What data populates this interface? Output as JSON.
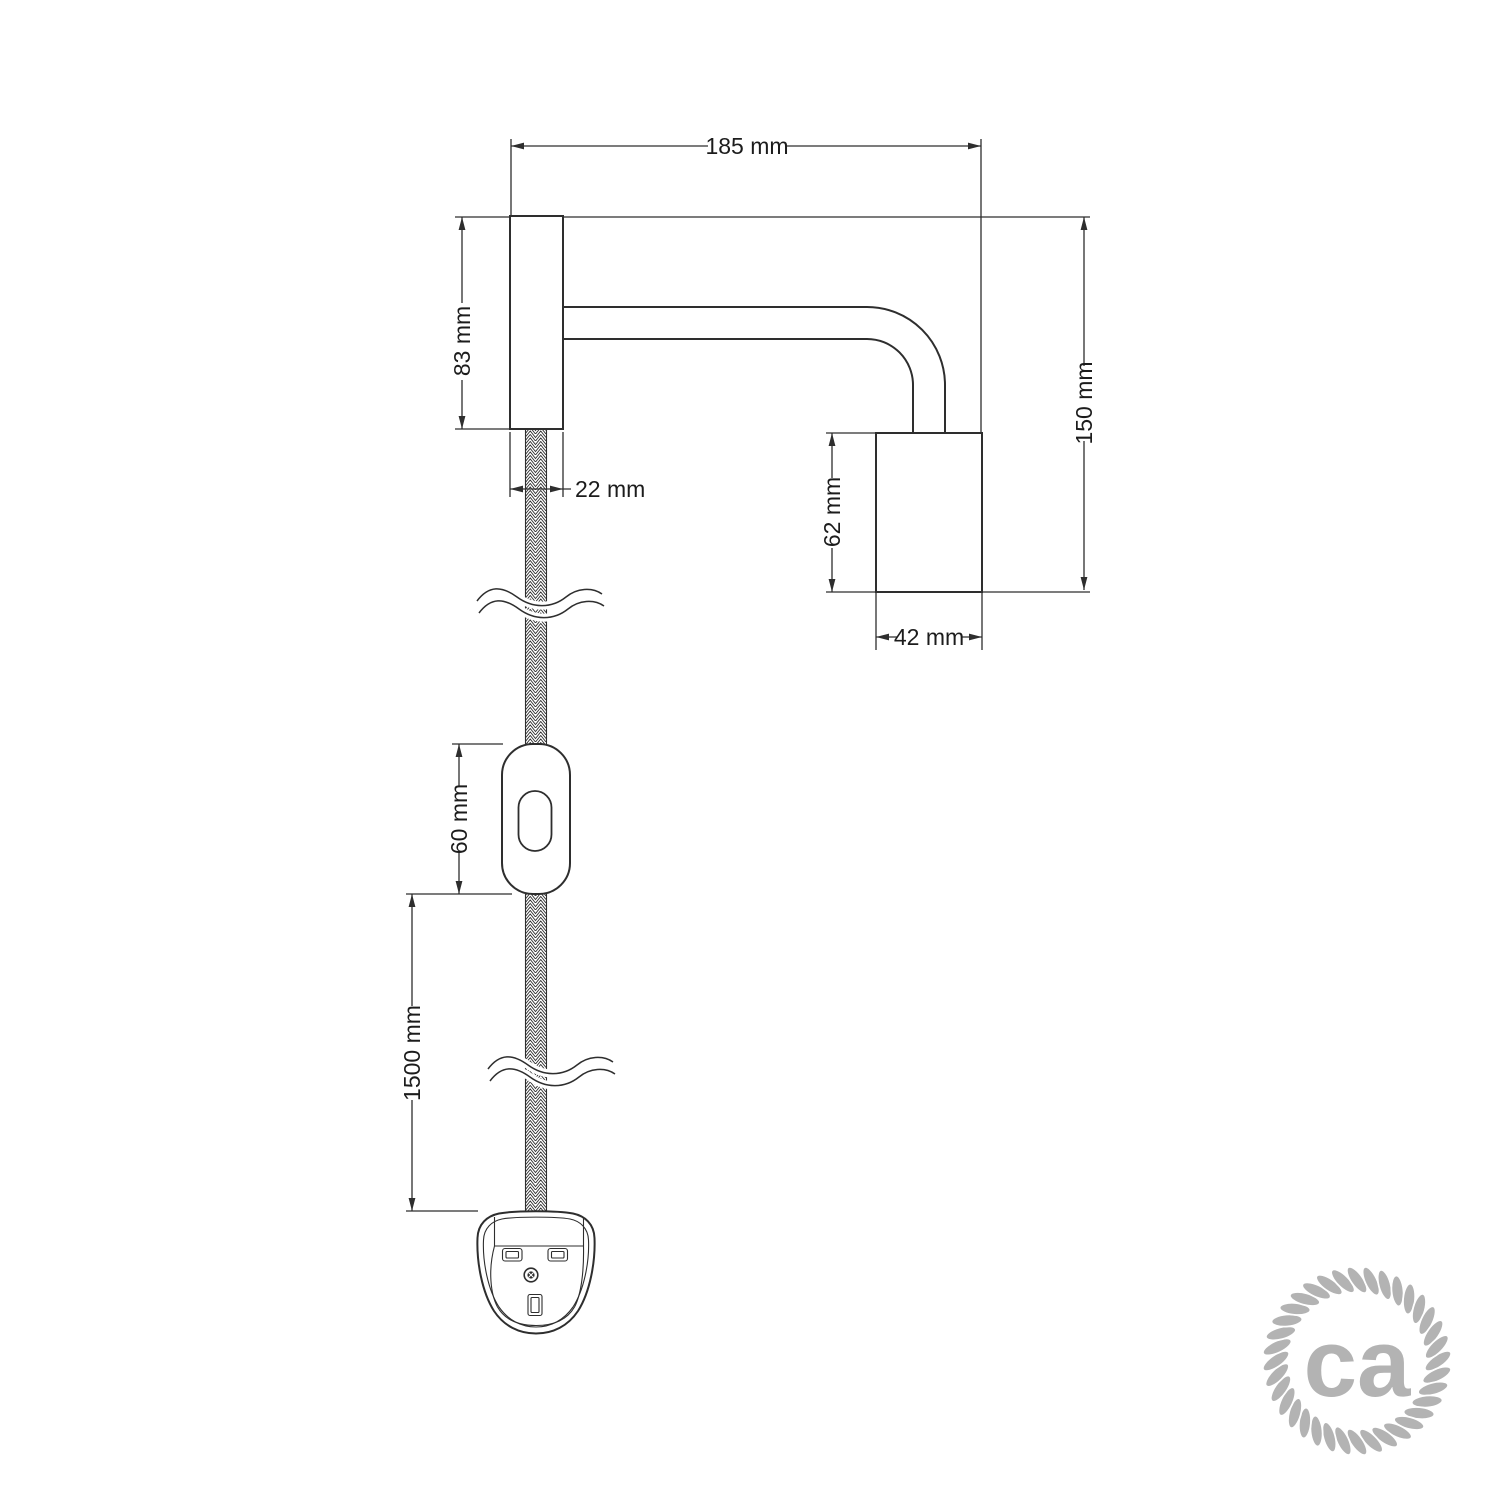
{
  "page": {
    "background_color": "#ffffff"
  },
  "drawing": {
    "kind": "technical-dimension-diagram",
    "subject": "wall spotlight with fabric cable, inline switch and plug",
    "line_color": "#2e2e2e",
    "label_color": "#1c1c1c",
    "labels": {
      "arm_projection": "185 mm",
      "wall_plate_height": "83 mm",
      "wall_plate_width": "22 mm",
      "overall_height": "150 mm",
      "lamp_holder_height": "62 mm",
      "lamp_holder_width": "42 mm",
      "switch_length": "60 mm",
      "cable_length": "1500 mm"
    }
  },
  "logo": {
    "text": "ca",
    "color": "#b3b3b3"
  }
}
